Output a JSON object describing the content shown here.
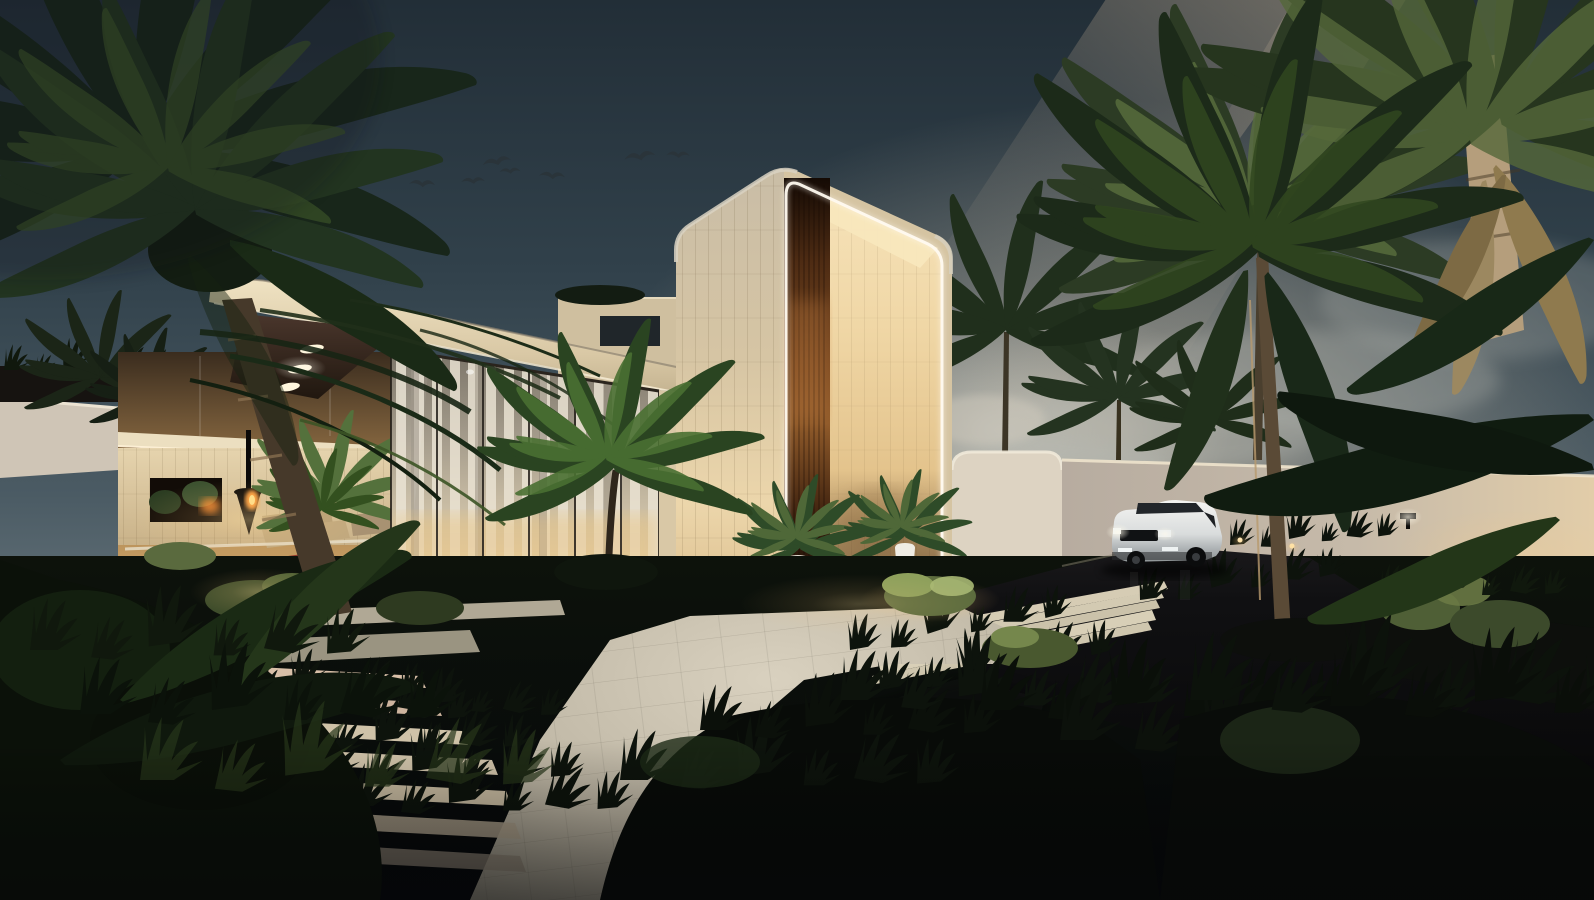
{
  "scene": {
    "title": "Twilight architectural rendering of a modern tropical luxury villa: lit entry portal tower with timber slats, curtained glass facade, suspended-fireplace lounge, palm trees, stone walkway and a white SUV in the dark driveway",
    "type": "architectural-exterior-render",
    "time_of_day": "dusk",
    "canvas": {
      "width": 1594,
      "height": 900
    },
    "objects": [
      {
        "name": "sky",
        "label": "Dusk sky with warm light beam and clouds"
      },
      {
        "name": "bird-flock",
        "label": "Flock of birds flying over the house"
      },
      {
        "name": "entry-portal-tower",
        "label": "Double-height rounded entry portal with LED edge light and timber slat wall"
      },
      {
        "name": "glass-facade",
        "label": "Floor-to-ceiling glazing with sheer white curtains"
      },
      {
        "name": "cantilever-roof",
        "label": "Cantilevered roof with dark timber soffit and recessed oval downlights"
      },
      {
        "name": "courtyard-lounge",
        "label": "Open lounge with suspended black fireplace, sofa and red floor ribbon"
      },
      {
        "name": "potted-plants",
        "label": "Potted banana plants flanking the entry"
      },
      {
        "name": "suv",
        "label": "White luxury SUV parked on the dark driveway"
      },
      {
        "name": "perimeter-wall",
        "label": "White perimeter wall with palms behind"
      },
      {
        "name": "palms",
        "label": "Coconut palms and tropical planting"
      },
      {
        "name": "stone-walkway",
        "label": "Stone plaza, plank steps and stepped pavers with grass joints"
      },
      {
        "name": "landscape-lighting",
        "label": "Bollard lights and shrub uplights"
      }
    ],
    "colors": {
      "sky_top": "#222e37",
      "sky_horizon": "#9aa2a0",
      "beam": "#e8cdaa",
      "cloud": "#b7b9b2",
      "bird": "#2a343a",
      "tower_front": "#d6c5a4",
      "tower_inner": "#f0d7a6",
      "timber_slats": "#7b4a22",
      "led_strip": "#fffaf0",
      "fascia": "#e9dab8",
      "soffit": "#32241d",
      "ceiling_light": "#fff6dd",
      "curtain": "#ebe4d4",
      "mullion": "#241f1a",
      "interior_glow": "#ffdfa0",
      "fire": "#ffa040",
      "red_path": "#8a2420",
      "sofa": "#c0a87e",
      "inner_block": "#ecdfc0",
      "pot": "#efece4",
      "leaf_dark": "#2e4b28",
      "leaf_lit": "#4f6838",
      "palm_silhouette": "#1c2a19",
      "trunk": "#5a4a36",
      "trunk_lit": "#b89a6e",
      "wall": "#c6baa9",
      "gate_volume": "#ddd3c2",
      "bollard_glow": "#ffe8b0",
      "car_body": "#e9ebeb",
      "car_glass": "#22262a",
      "car_grille": "#101214",
      "headlight": "#eef3f5",
      "wheel": "#0c0d0e",
      "driveway": "#0a0a0c",
      "plaza": "#cfc7b4",
      "paver_warm": "#d8bfa8",
      "step": "#d6ccb4",
      "lawn": "#0a0e08",
      "foliage_dark": "#0b1109",
      "grass": "#0d130c",
      "shrub_lit": "#8ea05c",
      "shrub_mid": "#5d6c3e"
    }
  }
}
